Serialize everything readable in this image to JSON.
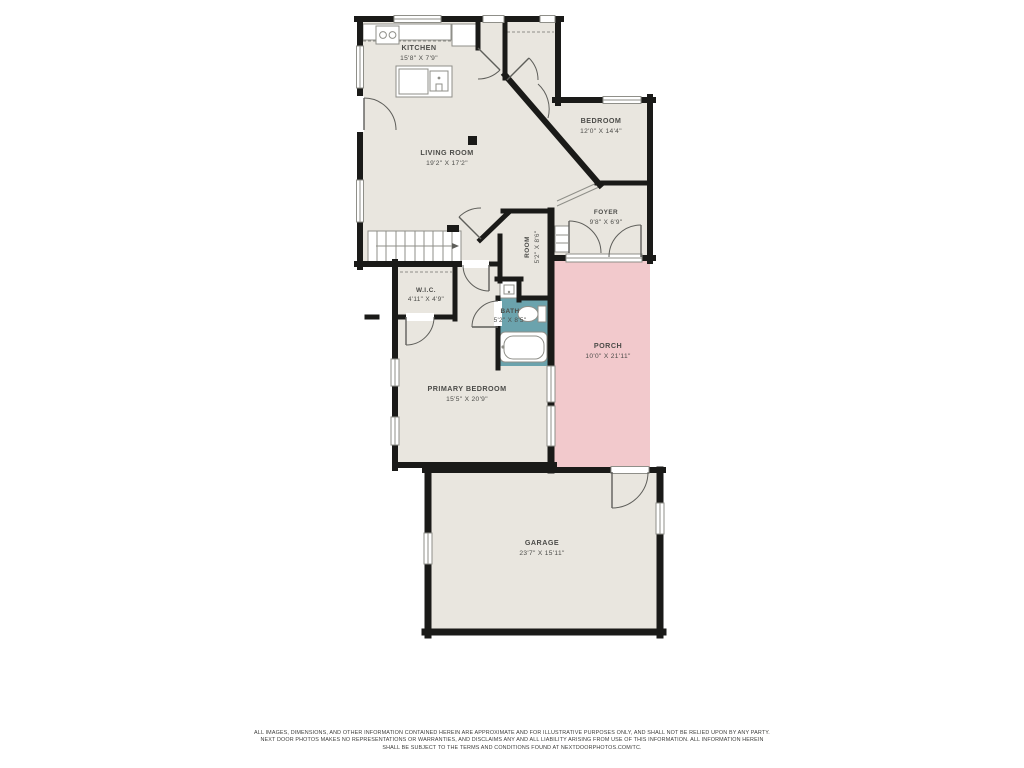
{
  "plan": {
    "rooms": {
      "kitchen": {
        "name": "KITCHEN",
        "dims": "15'8\" X 7'9\""
      },
      "living_room": {
        "name": "LIVING ROOM",
        "dims": "19'2\" X 17'2\""
      },
      "bedroom": {
        "name": "BEDROOM",
        "dims": "12'0\" X 14'4\""
      },
      "foyer": {
        "name": "FOYER",
        "dims": "9'8\" X 6'9\""
      },
      "flex_room": {
        "name": "ROOM",
        "dims": "5'2\" X 8'6\""
      },
      "wic": {
        "name": "W.I.C.",
        "dims": "4'11\" X 4'9\""
      },
      "bath": {
        "name": "BATH",
        "dims": "5'2\" X 8'5\""
      },
      "primary_bedroom": {
        "name": "PRIMARY BEDROOM",
        "dims": "15'5\" X 20'9\""
      },
      "porch": {
        "name": "PORCH",
        "dims": "10'0\" X 21'11\""
      },
      "garage": {
        "name": "GARAGE",
        "dims": "23'7\" X 15'11\""
      }
    },
    "colors": {
      "floor": "#e9e6df",
      "wall": "#1a1a18",
      "porch_fill": "#f2c9cc",
      "bath_fill": "#6ba3ad",
      "fixture_line": "#8f8f89",
      "label_text": "#4c4c49"
    },
    "disclaimer": [
      "ALL IMAGES, DIMENSIONS, AND OTHER INFORMATION CONTAINED HEREIN ARE APPROXIMATE AND FOR ILLUSTRATIVE PURPOSES ONLY, AND SHALL NOT BE RELIED UPON BY ANY PARTY.",
      "NEXT DOOR PHOTOS MAKES NO REPRESENTATIONS OR WARRANTIES, AND DISCLAIMS ANY AND ALL LIABILITY ARISING FROM USE OF THIS INFORMATION. ALL INFORMATION HEREIN",
      "SHALL BE SUBJECT TO THE TERMS AND CONDITIONS FOUND AT NEXTDOORPHOTOS.COM/TC."
    ]
  }
}
